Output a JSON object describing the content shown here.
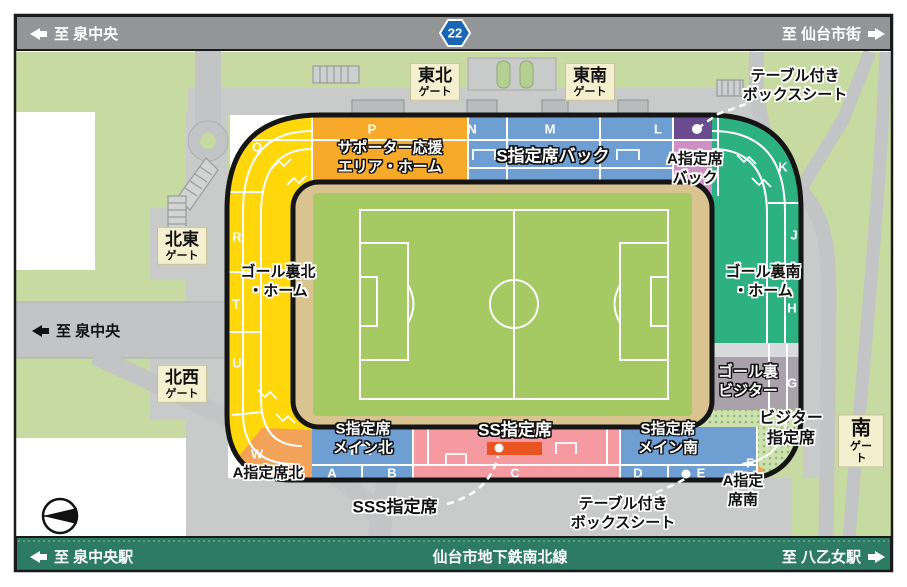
{
  "title": "ユアテックスタジアム仙台 座席・周辺マップ",
  "top_road": {
    "left_label": "至 泉中央",
    "route": "22",
    "right_label": "至 仙台市街"
  },
  "left_road": {
    "label": "至 泉中央"
  },
  "bottom_bar": {
    "left_label": "至 泉中央駅",
    "center_label": "仙台市地下鉄南北線",
    "right_label": "至 八乙女駅"
  },
  "gates": {
    "tohoku": {
      "l1": "東北",
      "l2": "ゲート"
    },
    "tonan": {
      "l1": "東南",
      "l2": "ゲート"
    },
    "hokuto": {
      "l1": "北東",
      "l2": "ゲート"
    },
    "hokusei": {
      "l1": "北西",
      "l2": "ゲート"
    },
    "minami": {
      "l1": "南",
      "l2": "ゲート"
    }
  },
  "stands": {
    "supporter": {
      "l1": "サポーター応援",
      "l2": "エリア・ホーム"
    },
    "s_back": {
      "label": "S指定席バック"
    },
    "a_back": {
      "l1": "A指定席",
      "l2": "バック"
    },
    "goal_north": {
      "l1": "ゴール裏北",
      "l2": "・ホーム"
    },
    "goal_south": {
      "l1": "ゴール裏南",
      "l2": "・ホーム"
    },
    "goal_visitor": {
      "l1": "ゴール裏",
      "l2": "ビジター"
    },
    "visitor_reserved": {
      "l1": "ビジター",
      "l2": "指定席"
    },
    "s_main_north": {
      "l1": "S指定席",
      "l2": "メイン北"
    },
    "s_main_south": {
      "l1": "S指定席",
      "l2": "メイン南"
    },
    "ss": {
      "label": "SS指定席"
    },
    "sss": {
      "label": "SSS指定席"
    },
    "a_north": {
      "label": "A指定席北"
    },
    "a_south": {
      "l1": "A指定",
      "l2": "席南"
    },
    "table_box_top": {
      "l1": "テーブル付き",
      "l2": "ボックスシート"
    },
    "table_box_bottom": {
      "l1": "テーブル付き",
      "l2": "ボックスシート"
    }
  },
  "blocks": {
    "p": "P",
    "n": "N",
    "m": "M",
    "l": "L",
    "q": "Q",
    "r": "R",
    "t": "T",
    "u": "U",
    "w": "W",
    "k": "K",
    "j": "J",
    "h": "H",
    "g": "G",
    "f": "F",
    "a": "A",
    "b": "B",
    "c": "C",
    "d": "D",
    "e": "E"
  },
  "colors": {
    "stand_yellow": "#ffd70a",
    "stand_orange": "#f7a929",
    "stand_orange_corner": "#f2a359",
    "stand_blue": "#6f9ed2",
    "stand_purple": "#6b4b8f",
    "stand_pink_violet": "#cf8fc4",
    "stand_green": "#2eb182",
    "stand_visitor_gray": "#a9a2ab",
    "stand_ss_pink": "#f49aa0",
    "sss_red": "#e95420",
    "field_green": "#a5ca63",
    "field_tan": "#d9c491",
    "bg_green": "#c7daa2",
    "road_gray": "#c2c4c5",
    "top_bar_gray": "#939597",
    "subway_green": "#2e7b64",
    "gate_cream": "#f4f0cf",
    "route_badge_blue": "#1866b4"
  }
}
